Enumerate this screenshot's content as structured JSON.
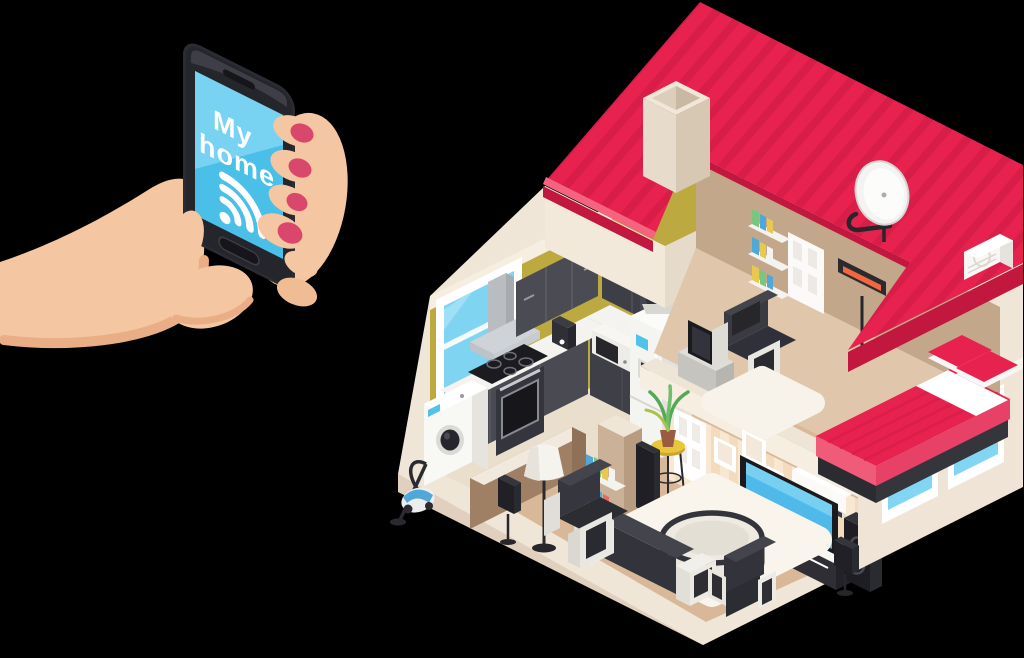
{
  "image_type": "flat vector illustration",
  "scene": {
    "background_color": "#000000",
    "concept": "hand holding smartphone with smart-home app controlling an isometric cutaway house"
  },
  "phone": {
    "screen_line1": "My",
    "screen_line2": "home",
    "text_color": "#FFFFFF",
    "screen_color": "#4ABFE8",
    "screen_highlight_color": "#80D5F2",
    "body_color": "#2B2B33",
    "wifi_icon": "wifi-icon"
  },
  "hand": {
    "skin_color": "#F5C6A2",
    "shade_color": "#E9AE85",
    "nail_color": "#D9486C"
  },
  "house": {
    "roof": {
      "color": "#E8224F",
      "stripe_color": "#D81E48",
      "fascia_color": "#C2173F",
      "chimney_color": "#E7DCCB",
      "satellite_dish_icon": "satellite-dish-icon"
    },
    "structure": {
      "platform_color": "#F1E7DA",
      "kitchen_wall_color": "#BCA93F",
      "bedroom_wall_color": "#C3A78B",
      "exterior_wall_color": "#EFE4D6",
      "wallpaper_stripe_colors": [
        "#F3DCBE",
        "#F9E8D1"
      ],
      "window_glass_color": "#7FD4F2",
      "kitchen_floor_color": "#EADFCC",
      "living_floor_color": "#D8B899",
      "bedroom_floor_color": "#E0C6AA"
    },
    "rooms": [
      {
        "name": "kitchen",
        "items": [
          "window",
          "range-hood",
          "upper-cabinets",
          "countertop",
          "induction-hob",
          "oven",
          "washing-machine",
          "vacuum-cleaner",
          "coffee-machine",
          "microwave",
          "sink",
          "refrigerator",
          "water-cooler-bottle",
          "partition-wall"
        ]
      },
      {
        "name": "living-room",
        "items": [
          "door",
          "picture-frames",
          "flat-tv",
          "tv-stand",
          "tower-speakers",
          "air-conditioner",
          "convector-heater",
          "satellite-speaker",
          "sofa",
          "armchairs",
          "round-glass-table",
          "white-rug",
          "floor-lamp",
          "bookshelf",
          "potted-plant",
          "stool",
          "partition-column"
        ]
      },
      {
        "name": "bedroom",
        "items": [
          "door",
          "wall-shelves-with-books",
          "armchair",
          "tv",
          "infrared-heater",
          "double-bed",
          "pillows",
          "white-rug",
          "exterior-ac-unit"
        ]
      }
    ]
  }
}
